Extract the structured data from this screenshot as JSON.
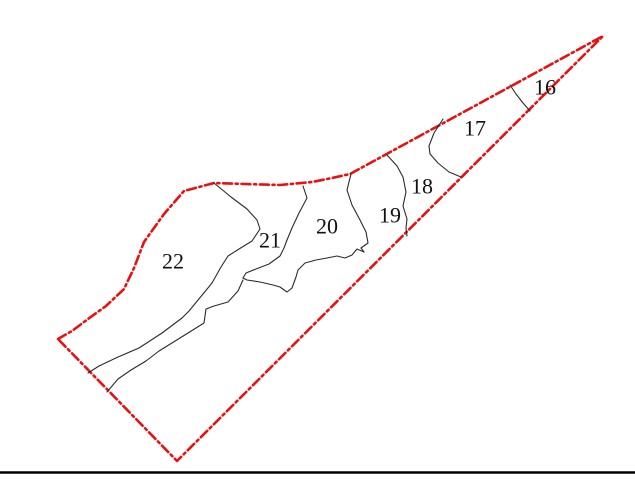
{
  "canvas": {
    "width": 635,
    "height": 479,
    "background": "#ffffff"
  },
  "styles": {
    "boundary_color": "#e81111",
    "boundary_width": 2.6,
    "boundary_dash": "9 3.6 2.2 3.6",
    "zone_line_color": "#2b2b2b",
    "zone_line_width": 1.1,
    "label_color": "#111111",
    "label_font_size": 22,
    "bottom_rule_color": "#000000",
    "bottom_rule_width": 2.4
  },
  "boundary": {
    "name": "site-boundary",
    "closed": true,
    "points": [
      [
        58,
        339
      ],
      [
        72,
        331
      ],
      [
        88,
        319
      ],
      [
        106,
        306
      ],
      [
        124,
        289
      ],
      [
        134,
        268
      ],
      [
        144,
        242
      ],
      [
        164,
        214
      ],
      [
        184,
        191
      ],
      [
        214,
        183
      ],
      [
        245,
        184
      ],
      [
        280,
        185
      ],
      [
        312,
        182
      ],
      [
        332,
        178
      ],
      [
        350,
        174
      ],
      [
        603,
        36
      ],
      [
        177,
        461
      ]
    ]
  },
  "zone_lines": [
    {
      "name": "divider-16-17",
      "points": [
        [
          510,
          85
        ],
        [
          516,
          94
        ],
        [
          523,
          103
        ],
        [
          530,
          111
        ]
      ]
    },
    {
      "name": "divider-17-18",
      "points": [
        [
          443,
          119
        ],
        [
          434,
          133
        ],
        [
          429,
          146
        ],
        [
          430,
          154
        ],
        [
          438,
          163
        ],
        [
          449,
          172
        ],
        [
          461,
          177
        ]
      ]
    },
    {
      "name": "divider-18-19",
      "points": [
        [
          387,
          155
        ],
        [
          397,
          166
        ],
        [
          403,
          177
        ],
        [
          406,
          192
        ],
        [
          403,
          206
        ],
        [
          407,
          219
        ],
        [
          406,
          228
        ],
        [
          407,
          236
        ]
      ]
    },
    {
      "name": "divider-19-20",
      "points": [
        [
          351,
          174
        ],
        [
          347,
          190
        ],
        [
          352,
          205
        ],
        [
          360,
          220
        ],
        [
          366,
          232
        ],
        [
          368,
          243
        ],
        [
          361,
          248
        ],
        [
          364,
          252
        ]
      ]
    },
    {
      "name": "zone-20-lower-edge",
      "points": [
        [
          364,
          252
        ],
        [
          357,
          249
        ],
        [
          352,
          255
        ],
        [
          345,
          258
        ],
        [
          337,
          256
        ],
        [
          327,
          258
        ],
        [
          316,
          260
        ],
        [
          305,
          263
        ],
        [
          298,
          270
        ],
        [
          296,
          277
        ],
        [
          292,
          288
        ],
        [
          287,
          292
        ],
        [
          280,
          287
        ],
        [
          273,
          285
        ],
        [
          260,
          282
        ],
        [
          247,
          280
        ],
        [
          243,
          278
        ]
      ]
    },
    {
      "name": "divider-20-21",
      "points": [
        [
          303,
          186
        ],
        [
          307,
          198
        ],
        [
          299,
          213
        ],
        [
          292,
          228
        ],
        [
          287,
          240
        ],
        [
          284,
          248
        ],
        [
          280,
          256
        ],
        [
          269,
          264
        ],
        [
          256,
          269
        ],
        [
          246,
          273
        ],
        [
          243,
          278
        ]
      ]
    },
    {
      "name": "divider-21-22",
      "points": [
        [
          214,
          183
        ],
        [
          231,
          197
        ],
        [
          247,
          209
        ],
        [
          257,
          220
        ],
        [
          260,
          229
        ],
        [
          252,
          241
        ],
        [
          239,
          249
        ],
        [
          228,
          256
        ],
        [
          221,
          267
        ],
        [
          212,
          283
        ],
        [
          203,
          294
        ],
        [
          189,
          311
        ],
        [
          182,
          318
        ],
        [
          162,
          333
        ],
        [
          139,
          348
        ],
        [
          118,
          357
        ],
        [
          99,
          366
        ],
        [
          88,
          373
        ]
      ]
    },
    {
      "name": "inner-strip-line",
      "points": [
        [
          243,
          280
        ],
        [
          238,
          291
        ],
        [
          228,
          302
        ],
        [
          214,
          306
        ],
        [
          206,
          309
        ],
        [
          204,
          323
        ],
        [
          180,
          338
        ],
        [
          159,
          351
        ],
        [
          146,
          361
        ],
        [
          131,
          370
        ],
        [
          118,
          379
        ],
        [
          107,
          392
        ]
      ]
    }
  ],
  "labels": [
    {
      "id": "zone-label-16",
      "text": "16",
      "x": 545,
      "y": 87
    },
    {
      "id": "zone-label-17",
      "text": "17",
      "x": 475,
      "y": 128
    },
    {
      "id": "zone-label-18",
      "text": "18",
      "x": 422,
      "y": 186
    },
    {
      "id": "zone-label-19",
      "text": "19",
      "x": 390,
      "y": 215
    },
    {
      "id": "zone-label-20",
      "text": "20",
      "x": 327,
      "y": 226
    },
    {
      "id": "zone-label-21",
      "text": "21",
      "x": 270,
      "y": 240
    },
    {
      "id": "zone-label-22",
      "text": "22",
      "x": 173,
      "y": 261
    }
  ],
  "bottom_rule": {
    "name": "frame-bottom-rule",
    "y": 472.5,
    "x1": 0,
    "x2": 635
  }
}
